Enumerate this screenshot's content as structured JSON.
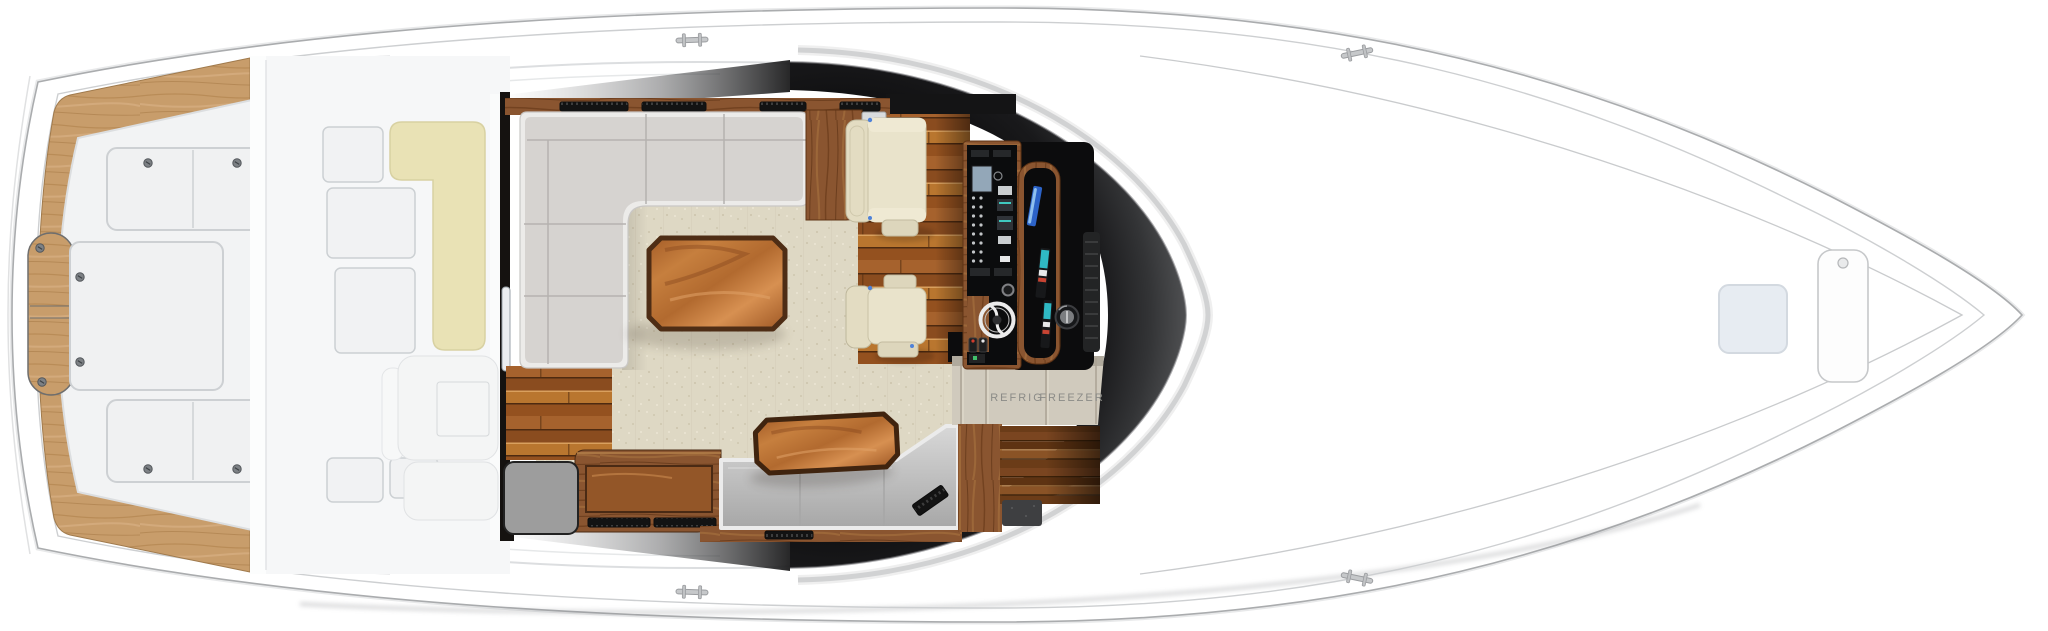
{
  "title": "Yacht deck floor plan (top view)",
  "labels": {
    "refrig": "REFRIG",
    "freezer": "FREEZER"
  },
  "palette": {
    "hull_white": "#ffffff",
    "hull_outline": "#aaacae",
    "teak_light": "#c89d6b",
    "teak_dark": "#8a5530",
    "cockpit_sole": "#f2f3f4",
    "cream_cushion": "#e9e2b5",
    "sofa_gray": "#d6d3d0",
    "carpet_beige": "#ded8c4",
    "table_wood": "#b4672f",
    "table_border": "#4e2d15",
    "bench_gray": "#c9c9c9",
    "helm_black": "#0d0d0e",
    "bridge_shadow": "#2b2c2e",
    "chair_bone": "#e5dfc8",
    "label_gray": "#8b8b87",
    "bow_hatch_blue": "#e7ecf2",
    "screen_blue": "#2c63c8",
    "screen_teal": "#2fb9c4"
  },
  "regions": [
    "cockpit",
    "transom-door",
    "cockpit-hatches",
    "mezzanine",
    "mezzanine-cushion",
    "salon",
    "sectional-sofa",
    "coffee-table",
    "teak-cabinet",
    "helm-chairs",
    "helm-console",
    "steering-wheel",
    "compass",
    "electronics-pod",
    "galley-cabinets",
    "bench-seat",
    "aft-table",
    "sideboard",
    "foredeck",
    "bow-hatches",
    "cleats"
  ]
}
